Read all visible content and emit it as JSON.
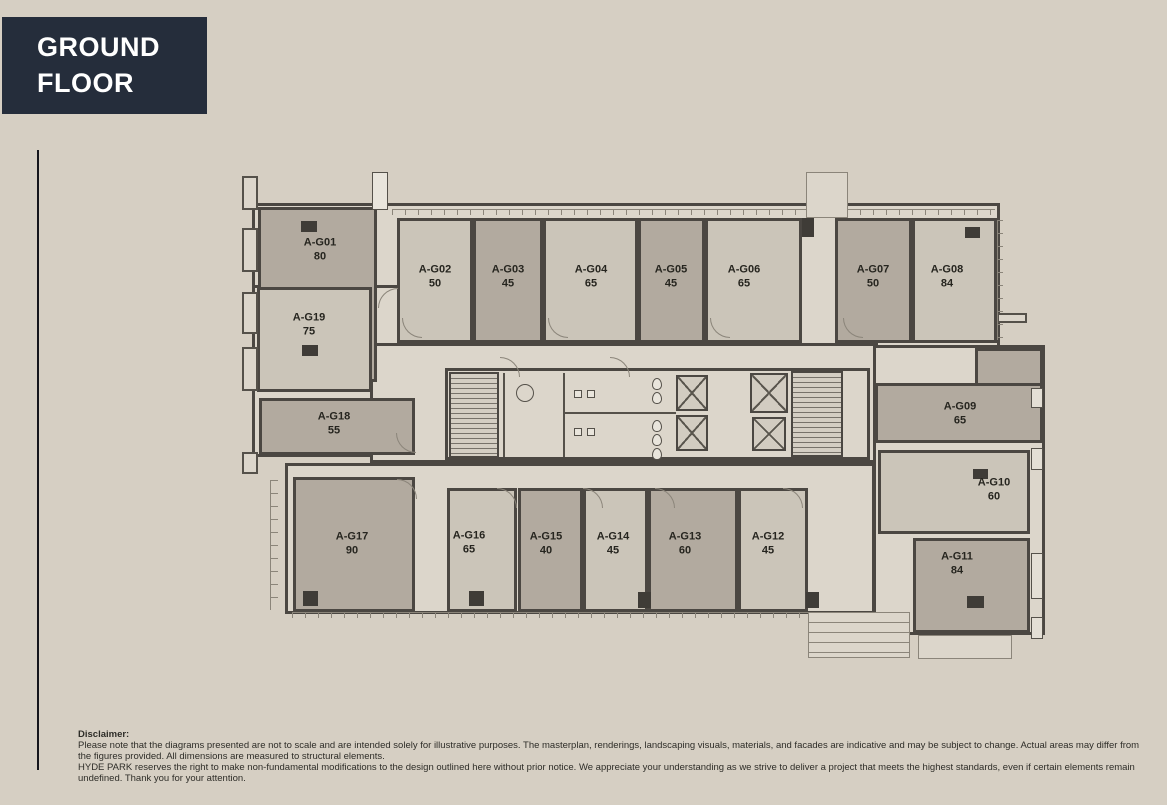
{
  "header": {
    "title": "GROUND FLOOR"
  },
  "colors": {
    "background": "#d6cfc3",
    "panel": "#dcd6cb",
    "unit_dark": "#b2aa9f",
    "unit_light": "#cbc5b9",
    "wall": "#4b4742",
    "title_bg": "#252d3b",
    "title_text": "#ffffff",
    "label_text": "#26251f"
  },
  "floorplan": {
    "silhouette": [
      [
        252,
        203,
        748,
        145
      ],
      [
        252,
        285,
        166,
        172
      ],
      [
        370,
        343,
        508,
        120
      ],
      [
        285,
        463,
        590,
        151
      ],
      [
        873,
        345,
        172,
        290
      ]
    ],
    "core": [
      445,
      368,
      425,
      92
    ],
    "units": [
      {
        "id": "A-G01",
        "area": "80",
        "fill": "dark",
        "rect": [
          258,
          207,
          119,
          175
        ],
        "label": [
          320,
          250
        ]
      },
      {
        "id": "A-G02",
        "area": "50",
        "fill": "light",
        "rect": [
          397,
          218,
          76,
          125
        ],
        "label": [
          435,
          277
        ]
      },
      {
        "id": "A-G03",
        "area": "45",
        "fill": "dark",
        "rect": [
          473,
          218,
          70,
          125
        ],
        "label": [
          508,
          277
        ]
      },
      {
        "id": "A-G04",
        "area": "65",
        "fill": "light",
        "rect": [
          543,
          218,
          95,
          125
        ],
        "label": [
          591,
          277
        ]
      },
      {
        "id": "A-G05",
        "area": "45",
        "fill": "dark",
        "rect": [
          638,
          218,
          67,
          125
        ],
        "label": [
          671,
          277
        ]
      },
      {
        "id": "A-G06",
        "area": "65",
        "fill": "light",
        "rect": [
          705,
          218,
          97,
          125
        ],
        "label": [
          744,
          277
        ]
      },
      {
        "id": "A-G07",
        "area": "50",
        "fill": "dark",
        "rect": [
          835,
          218,
          77,
          125
        ],
        "label": [
          873,
          277
        ]
      },
      {
        "id": "A-G08",
        "area": "84",
        "fill": "light",
        "rect": [
          912,
          218,
          85,
          125
        ],
        "label": [
          947,
          277
        ]
      },
      {
        "id": "A-G09",
        "area": "65",
        "fill": "dark",
        "rect": [
          875,
          383,
          168,
          60
        ],
        "label": [
          960,
          414
        ]
      },
      {
        "id": "A-G10",
        "area": "60",
        "fill": "light",
        "rect": [
          878,
          450,
          152,
          84
        ],
        "label": [
          994,
          490
        ]
      },
      {
        "id": "A-G11",
        "area": "84",
        "fill": "dark",
        "rect": [
          913,
          538,
          117,
          95
        ],
        "label": [
          957,
          564
        ]
      },
      {
        "id": "A-G12",
        "area": "45",
        "fill": "light",
        "rect": [
          738,
          488,
          70,
          124
        ],
        "label": [
          768,
          544
        ]
      },
      {
        "id": "A-G13",
        "area": "60",
        "fill": "dark",
        "rect": [
          648,
          488,
          90,
          124
        ],
        "label": [
          685,
          544
        ]
      },
      {
        "id": "A-G14",
        "area": "45",
        "fill": "light",
        "rect": [
          583,
          488,
          65,
          124
        ],
        "label": [
          613,
          544
        ]
      },
      {
        "id": "A-G15",
        "area": "40",
        "fill": "dark",
        "rect": [
          518,
          488,
          65,
          124
        ],
        "label": [
          546,
          544
        ]
      },
      {
        "id": "A-G16",
        "area": "65",
        "fill": "light",
        "rect": [
          447,
          488,
          70,
          124
        ],
        "label": [
          469,
          543
        ]
      },
      {
        "id": "A-G17",
        "area": "90",
        "fill": "dark",
        "rect": [
          293,
          477,
          122,
          135
        ],
        "label": [
          352,
          544
        ]
      },
      {
        "id": "A-G18",
        "area": "55",
        "fill": "dark",
        "rect": [
          259,
          398,
          156,
          57
        ],
        "label": [
          334,
          424
        ]
      },
      {
        "id": "A-G19",
        "area": "75",
        "fill": "light",
        "rect": [
          257,
          287,
          115,
          105
        ],
        "label": [
          309,
          325
        ]
      }
    ],
    "extras": [
      {
        "fill": "dark",
        "rect": [
          975,
          348,
          68,
          40
        ]
      }
    ],
    "stairs": [
      [
        449,
        372,
        50,
        86
      ],
      [
        791,
        371,
        52,
        86
      ]
    ],
    "elevators": [
      [
        676,
        375,
        32,
        36
      ],
      [
        676,
        415,
        32,
        36
      ],
      [
        750,
        373,
        38,
        40
      ],
      [
        752,
        417,
        34,
        34
      ]
    ],
    "core_walls": [
      [
        503,
        373,
        2,
        84
      ],
      [
        563,
        373,
        2,
        84
      ],
      [
        563,
        412,
        113,
        2
      ]
    ],
    "toilets": [
      [
        652,
        378
      ],
      [
        652,
        392
      ],
      [
        652,
        420
      ],
      [
        652,
        434
      ],
      [
        652,
        448
      ]
    ],
    "sinks": [
      [
        574,
        390
      ],
      [
        587,
        390
      ],
      [
        574,
        428
      ],
      [
        587,
        428
      ]
    ],
    "wc_circle": [
      516,
      384,
      18
    ],
    "columns": [
      [
        301,
        221,
        16,
        11
      ],
      [
        302,
        345,
        16,
        11
      ],
      [
        965,
        227,
        15,
        11
      ],
      [
        973,
        469,
        15,
        10
      ],
      [
        967,
        596,
        17,
        12
      ],
      [
        303,
        591,
        15,
        15
      ],
      [
        469,
        591,
        15,
        15
      ],
      [
        638,
        592,
        13,
        16
      ],
      [
        806,
        592,
        13,
        16
      ],
      [
        802,
        218,
        12,
        19
      ]
    ],
    "doors": [
      [
        402,
        318,
        0
      ],
      [
        548,
        318,
        0
      ],
      [
        710,
        318,
        0
      ],
      [
        843,
        318,
        0
      ],
      [
        378,
        288,
        90
      ],
      [
        396,
        433,
        0
      ],
      [
        497,
        488,
        180
      ],
      [
        583,
        488,
        180
      ],
      [
        655,
        488,
        180
      ],
      [
        783,
        488,
        180
      ],
      [
        397,
        479,
        180
      ],
      [
        500,
        357,
        180
      ],
      [
        610,
        357,
        180
      ]
    ],
    "balconies": [
      [
        242,
        176,
        16,
        34
      ],
      [
        242,
        228,
        16,
        44
      ],
      [
        242,
        292,
        16,
        42
      ],
      [
        242,
        347,
        16,
        44
      ],
      [
        242,
        452,
        16,
        22
      ],
      [
        997,
        313,
        30,
        10
      ]
    ],
    "windows": [
      [
        1031,
        388,
        12,
        20
      ],
      [
        1031,
        448,
        12,
        22
      ],
      [
        1031,
        553,
        12,
        46
      ],
      [
        1031,
        617,
        12,
        22
      ]
    ],
    "rulers": [
      {
        "dir": "h",
        "rect": [
          392,
          209,
          603,
          6
        ]
      },
      {
        "dir": "h",
        "rect": [
          292,
          612,
          520,
          6
        ]
      },
      {
        "dir": "v",
        "rect": [
          997,
          220,
          6,
          120
        ]
      },
      {
        "dir": "v",
        "rect": [
          270,
          480,
          8,
          130
        ]
      }
    ],
    "shafts": [
      [
        372,
        172,
        16,
        38
      ]
    ],
    "vestibule": [
      806,
      172,
      42,
      46
    ],
    "canopy": [
      808,
      612,
      102,
      46
    ],
    "porch": [
      918,
      635,
      94,
      24
    ]
  },
  "disclaimer": {
    "heading": "Disclaimer:",
    "para1": "Please note that the diagrams presented are not to scale and are intended solely for illustrative purposes. The masterplan, renderings, landscaping visuals, materials, and facades are indicative and may be subject to change. Actual areas may differ from the figures provided. All dimensions are measured to structural elements.",
    "para2": "HYDE PARK reserves the right to make non-fundamental modifications to the design outlined here without prior notice. We appreciate your understanding as we strive to deliver a project that meets the highest standards, even if certain elements remain undefined. Thank you for your attention."
  }
}
